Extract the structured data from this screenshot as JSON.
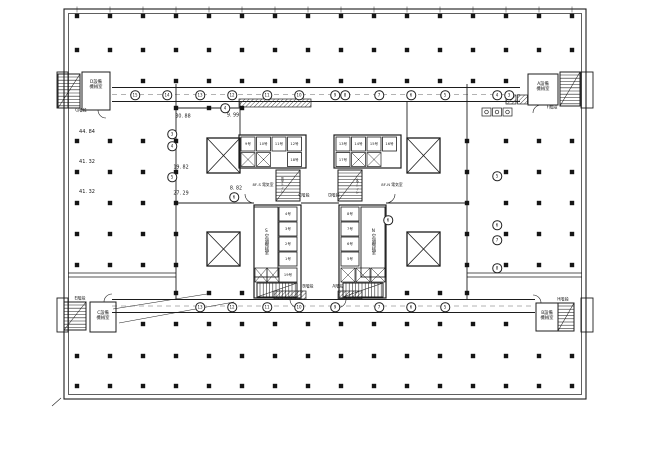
{
  "drawing": {
    "kind": "architectural-floor-plan-scan",
    "ink_color": "#1d1d1d",
    "paper_color": "#ffffff"
  },
  "canvas": {
    "width": 650,
    "height": 456
  },
  "labels": [
    {
      "id": "room-d-machine-label",
      "t": "D設備機械室",
      "x": 96,
      "y": 86,
      "s": 4.3,
      "w": 15
    },
    {
      "id": "stair-g-label",
      "t": "G階段",
      "x": 81,
      "y": 111,
      "s": 4.2
    },
    {
      "id": "room-a-machine-label",
      "t": "A設備機械室",
      "x": 543,
      "y": 88,
      "s": 4.3,
      "w": 15
    },
    {
      "id": "stair-f-label",
      "t": "F階段",
      "x": 552,
      "y": 108,
      "s": 4.2
    },
    {
      "id": "room-c-machine-label",
      "t": "C設備機械室",
      "x": 103,
      "y": 317,
      "s": 4.3,
      "w": 15
    },
    {
      "id": "stair-e-label",
      "t": "E階段",
      "x": 80,
      "y": 299,
      "s": 4.2
    },
    {
      "id": "room-b-machine-label",
      "t": "B設備機械室",
      "x": 547,
      "y": 317,
      "s": 4.3,
      "w": 15
    },
    {
      "id": "stair-h-label",
      "t": "H階段",
      "x": 563,
      "y": 300,
      "s": 4.2
    },
    {
      "id": "stair-c-label",
      "t": "C階段",
      "x": 304,
      "y": 196,
      "s": 4.2
    },
    {
      "id": "stair-d-label",
      "t": "D階段",
      "x": 334,
      "y": 196,
      "s": 4.2
    },
    {
      "id": "stair-b-label",
      "t": "B階段",
      "x": 308,
      "y": 287,
      "s": 4.2
    },
    {
      "id": "stair-a-label",
      "t": "A階段",
      "x": 338,
      "y": 287,
      "s": 4.2
    },
    {
      "id": "ac-room-s-label",
      "t": "S空調機械室",
      "x": 265.5,
      "y": 242,
      "s": 4.3,
      "v": true
    },
    {
      "id": "ac-room-n-label",
      "t": "N空調機械室",
      "x": 372.5,
      "y": 242,
      "s": 4.3,
      "v": true
    },
    {
      "id": "electric-room-s-label",
      "t": "8F-S 電気室",
      "x": 263,
      "y": 185,
      "s": 3.8
    },
    {
      "id": "electric-room-n-label",
      "t": "8F-N 電気室",
      "x": 392,
      "y": 185,
      "s": 3.8
    },
    {
      "id": "toilet-s-label",
      "t": "男子トイレ",
      "x": 281,
      "y": 185,
      "s": 3.2,
      "v": true
    },
    {
      "id": "toilet-n-label",
      "t": "女子トイレ",
      "x": 356,
      "y": 186,
      "s": 3.2,
      "v": true
    },
    {
      "id": "dim-left-1",
      "t": "44. 84",
      "x": 87,
      "y": 133,
      "s": 5
    },
    {
      "id": "dim-left-2",
      "t": "41. 32",
      "x": 87,
      "y": 163,
      "s": 5
    },
    {
      "id": "dim-left-3",
      "t": "41. 32",
      "x": 87,
      "y": 193,
      "s": 5
    },
    {
      "id": "dim-30-88",
      "t": "30. 88",
      "x": 183,
      "y": 117,
      "s": 4.8
    },
    {
      "id": "dim-9-99",
      "t": "9. 99",
      "x": 233,
      "y": 116,
      "s": 4.8
    },
    {
      "id": "dim-19-82",
      "t": "19. 82",
      "x": 181,
      "y": 168,
      "s": 4.8
    },
    {
      "id": "dim-27-29",
      "t": "27. 29",
      "x": 181,
      "y": 194,
      "s": 4.8
    },
    {
      "id": "dim-8-82",
      "t": "8. 82",
      "x": 236,
      "y": 189,
      "s": 4.8
    },
    {
      "id": "elevator-9-label",
      "t": "9号",
      "x": 248,
      "y": 144,
      "s": 3.6
    },
    {
      "id": "elevator-10-label",
      "t": "10号",
      "x": 263.5,
      "y": 144,
      "s": 3.6
    },
    {
      "id": "elevator-11-label",
      "t": "11号",
      "x": 279,
      "y": 144,
      "s": 3.6
    },
    {
      "id": "elevator-12-label",
      "t": "12号",
      "x": 294.5,
      "y": 144,
      "s": 3.6
    },
    {
      "id": "elevator-18-label",
      "t": "18号",
      "x": 294.5,
      "y": 159.5,
      "s": 3.6
    },
    {
      "id": "elevator-13-label",
      "t": "13号",
      "x": 343,
      "y": 144,
      "s": 3.6
    },
    {
      "id": "elevator-14-label",
      "t": "14号",
      "x": 358.5,
      "y": 144,
      "s": 3.6
    },
    {
      "id": "elevator-15-label",
      "t": "15号",
      "x": 374,
      "y": 144,
      "s": 3.6
    },
    {
      "id": "elevator-16-label",
      "t": "16号",
      "x": 389.5,
      "y": 144,
      "s": 3.6
    },
    {
      "id": "elevator-17-label",
      "t": "17号",
      "x": 343,
      "y": 159.5,
      "s": 3.6
    },
    {
      "id": "elevator-4-label",
      "t": "4号",
      "x": 288,
      "y": 214,
      "s": 3.6
    },
    {
      "id": "elevator-3-label",
      "t": "3号",
      "x": 288,
      "y": 229,
      "s": 3.6
    },
    {
      "id": "elevator-2-label",
      "t": "2号",
      "x": 288,
      "y": 244,
      "s": 3.6
    },
    {
      "id": "elevator-1-label",
      "t": "1号",
      "x": 288,
      "y": 259,
      "s": 3.6
    },
    {
      "id": "elevator-19-label",
      "t": "19号",
      "x": 288,
      "y": 275,
      "s": 3.6
    },
    {
      "id": "elevator-8-label",
      "t": "8号",
      "x": 350,
      "y": 214,
      "s": 3.6
    },
    {
      "id": "elevator-7-label",
      "t": "7号",
      "x": 350,
      "y": 229,
      "s": 3.6
    },
    {
      "id": "elevator-6-label",
      "t": "6号",
      "x": 350,
      "y": 244,
      "s": 3.6
    },
    {
      "id": "elevator-5-label",
      "t": "5号",
      "x": 350,
      "y": 259,
      "s": 3.6
    }
  ],
  "grid_bubbles": [
    {
      "n": "15",
      "x": 135,
      "y": 95
    },
    {
      "n": "14",
      "x": 167,
      "y": 95
    },
    {
      "n": "13",
      "x": 200,
      "y": 95
    },
    {
      "n": "12",
      "x": 232,
      "y": 95
    },
    {
      "n": "11",
      "x": 267,
      "y": 95
    },
    {
      "n": "10",
      "x": 299,
      "y": 95
    },
    {
      "n": "9",
      "x": 335,
      "y": 95
    },
    {
      "n": "8",
      "x": 345,
      "y": 95
    },
    {
      "n": "7",
      "x": 379,
      "y": 95
    },
    {
      "n": "6",
      "x": 411,
      "y": 95
    },
    {
      "n": "5",
      "x": 445,
      "y": 95
    },
    {
      "n": "4",
      "x": 497,
      "y": 95
    },
    {
      "n": "3",
      "x": 509,
      "y": 95
    },
    {
      "n": "13",
      "x": 200,
      "y": 307
    },
    {
      "n": "12",
      "x": 232,
      "y": 307
    },
    {
      "n": "11",
      "x": 267,
      "y": 307
    },
    {
      "n": "10",
      "x": 299,
      "y": 307
    },
    {
      "n": "9",
      "x": 335,
      "y": 307
    },
    {
      "n": "7",
      "x": 379,
      "y": 307
    },
    {
      "n": "6",
      "x": 411,
      "y": 307
    },
    {
      "n": "5",
      "x": 445,
      "y": 307
    },
    {
      "n": "3",
      "x": 172,
      "y": 134
    },
    {
      "n": "4",
      "x": 172,
      "y": 146
    },
    {
      "n": "5",
      "x": 172,
      "y": 177
    },
    {
      "n": "4",
      "x": 225,
      "y": 108
    },
    {
      "n": "6",
      "x": 234,
      "y": 197
    },
    {
      "n": "5",
      "x": 497,
      "y": 176
    },
    {
      "n": "6",
      "x": 497,
      "y": 225
    },
    {
      "n": "7",
      "x": 497,
      "y": 240
    },
    {
      "n": "8",
      "x": 497,
      "y": 268
    },
    {
      "n": "6",
      "x": 388,
      "y": 220
    }
  ]
}
